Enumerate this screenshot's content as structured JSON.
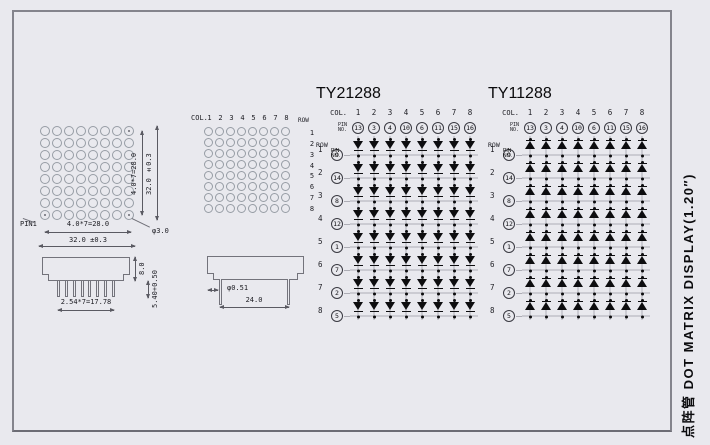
{
  "labels": {
    "side_label": "点阵管 DOT MATRIX DISPLAY(1.20″)"
  },
  "front_view": {
    "grid": {
      "rows": 8,
      "cols": 8
    },
    "marked_cells": [
      "0,7",
      "7,0",
      "7,7"
    ],
    "dims": {
      "inner_vertical": "4.0*7=28.0",
      "outer_vertical": "32.0 ±0.3",
      "inner_horizontal": "4.0*7=28.0",
      "outer_horizontal": "32.0 ±0.3",
      "pin1": "PIN1",
      "hole_diameter": "φ3.0"
    }
  },
  "left_side_view": {
    "pin_count": 8,
    "dims": {
      "body_height": "8.0",
      "pin_length": "5.40+0.50",
      "pin_pitch": "2.54*7=17.78"
    }
  },
  "back_view": {
    "col_label": "COL.",
    "row_label": "ROW",
    "col_numbers": [
      "1",
      "2",
      "3",
      "4",
      "5",
      "6",
      "7",
      "8"
    ],
    "row_numbers": [
      "1",
      "2",
      "3",
      "4",
      "5",
      "6",
      "7",
      "8"
    ],
    "grid": {
      "rows": 8,
      "cols": 8
    }
  },
  "mid_side_view": {
    "dims": {
      "pin_diameter": "φ0.51",
      "pin_span": "24.0"
    }
  },
  "schematics": [
    {
      "title": "TY21288",
      "diode_direction": "down",
      "col_label": "COL.",
      "row_label": "ROW",
      "pin_no_label": "PIN\nNO.",
      "col_numbers": [
        "1",
        "2",
        "3",
        "4",
        "5",
        "6",
        "7",
        "8"
      ],
      "col_pins": [
        "13",
        "3",
        "4",
        "10",
        "6",
        "11",
        "15",
        "16"
      ],
      "row_numbers": [
        "1",
        "2",
        "3",
        "4",
        "5",
        "6",
        "7",
        "8"
      ],
      "row_pins": [
        "9",
        "14",
        "8",
        "12",
        "1",
        "7",
        "2",
        "5"
      ]
    },
    {
      "title": "TY11288",
      "diode_direction": "up",
      "col_label": "COL.",
      "row_label": "ROW",
      "pin_no_label": "PIN\nNO.",
      "col_numbers": [
        "1",
        "2",
        "3",
        "4",
        "5",
        "6",
        "7",
        "8"
      ],
      "col_pins": [
        "13",
        "3",
        "4",
        "10",
        "6",
        "11",
        "15",
        "16"
      ],
      "row_numbers": [
        "1",
        "2",
        "3",
        "4",
        "5",
        "6",
        "7",
        "8"
      ],
      "row_pins": [
        "9",
        "14",
        "8",
        "12",
        "1",
        "7",
        "2",
        "5"
      ]
    }
  ]
}
